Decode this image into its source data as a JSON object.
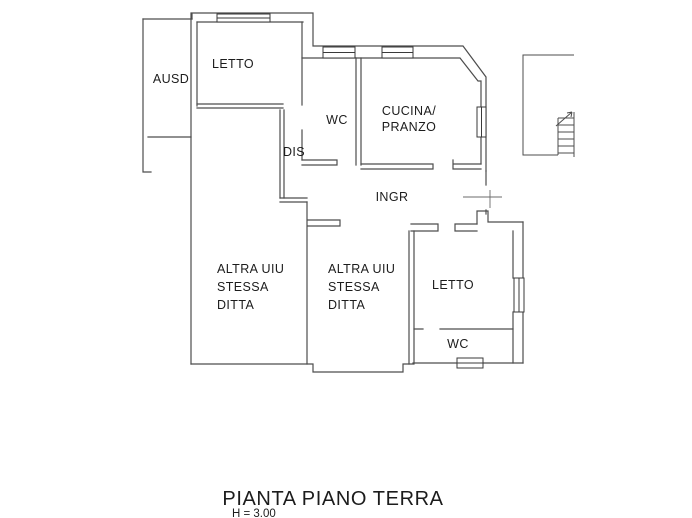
{
  "drawing": {
    "title": "PIANTA PIANO TERRA",
    "height_note": "H = 3.00",
    "labels": {
      "ausd": "AUSD",
      "letto_top": "LETTO",
      "wc_top": "WC",
      "cucina_line1": "CUCINA/",
      "cucina_line2": "PRANZO",
      "dis": "DIS",
      "ingr": "INGR",
      "altra_line1": "ALTRA UIU",
      "altra_line2": "STESSA",
      "altra_line3": "DITTA",
      "letto_bottom": "LETTO",
      "wc_bottom": "WC"
    },
    "colors": {
      "wall": "#4d4d4d",
      "window": "#3a3a3a",
      "text": "#1c1c1c",
      "background": "#ffffff"
    }
  }
}
